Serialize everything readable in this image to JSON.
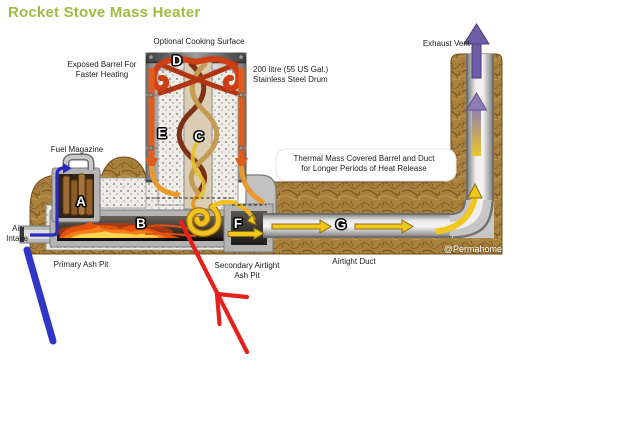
{
  "title": "Rocket Stove Mass Heater",
  "watermark": "@Permahome",
  "labels": {
    "optional_cooking_surface": "Optional Cooking Surface",
    "exposed_barrel": "Exposed Barrel For\nFaster Heating",
    "drum": "200 litre (55 US Gal.)\nStainless Steel Drum",
    "exhaust_vent": "Exhaust Vent",
    "fuel_magazine": "Fuel Magazine",
    "air_intake": "Air\nIntake",
    "thermal_mass": "Thermal Mass Covered Barrel and Duct\nfor Longer Periods of Heat Release",
    "primary_ash_pit": "Primary Ash Pit",
    "secondary_ash_pit": "Secondary Airtight\nAsh Pit",
    "airtight_duct": "Airtight Duct"
  },
  "markers": {
    "A": "A",
    "B": "B",
    "C": "C",
    "D": "D",
    "E": "E",
    "F": "F",
    "G": "G"
  },
  "colors": {
    "title_green": "#9CBD41",
    "thermal_mass_brown": "#A9813D",
    "hot_gas_red": "#CE3F16",
    "duct_arrow_yellow": "#F2C71D",
    "exhaust_purple": "#6F5DA8",
    "air_intake_blue": "#2A2ABF",
    "annotation_red": "#E3221E",
    "annotation_blue": "#3236C8"
  }
}
